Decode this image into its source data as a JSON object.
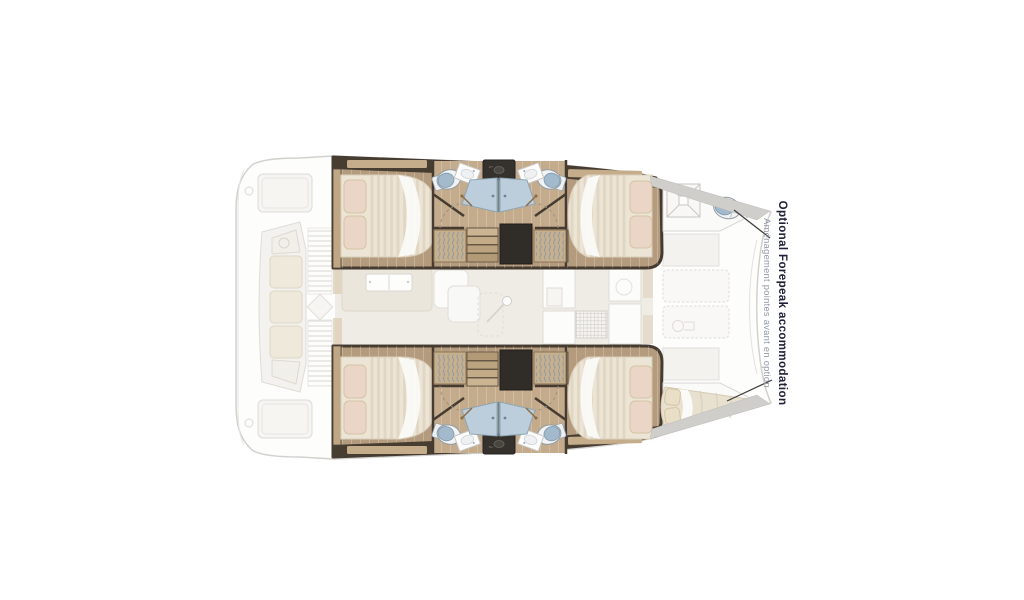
{
  "diagram": {
    "type": "catamaran-interior-floor-plan",
    "annotation": {
      "title": "Optional Forepeak accommodation",
      "subtitle": "Aménagement pointes avant en option",
      "title_color": "#20203a",
      "subtitle_color": "#9097a5",
      "leader_color": "#3d3d3d"
    },
    "features": [
      "aft-cabin-port-double-bed",
      "forward-cabin-port-double-bed",
      "aft-cabin-starboard-double-bed",
      "forward-cabin-starboard-double-bed",
      "bathroom-port-with-shower",
      "bathroom-starboard-with-shower",
      "companionway-stairs-port",
      "companionway-stairs-starboard",
      "forepeak-port-toilet",
      "forepeak-starboard-berth",
      "saloon",
      "galley",
      "aft-cockpit",
      "foredeck-lockers"
    ],
    "colors": {
      "wood_floor": "#b49b7d",
      "wood_floor_light": "#c3ab8c",
      "wood_trim": "#bfa685",
      "dark_wall": "#463b30",
      "hatch_dark": "#302c28",
      "bed_linen": "#ece4d4",
      "bed_stripe": "#dcd1bc",
      "pillow": "#ead5c7",
      "sheet_white": "#fafaf8",
      "shower_glass": "#bccedb",
      "toilet_lid": "#a3bacc",
      "pad_stripe_blue": "#7d92a8",
      "faded_line": "#d2d1ce",
      "faded_fill": "#f5f4f1",
      "gunwale_gray": "#cfcecb"
    }
  }
}
